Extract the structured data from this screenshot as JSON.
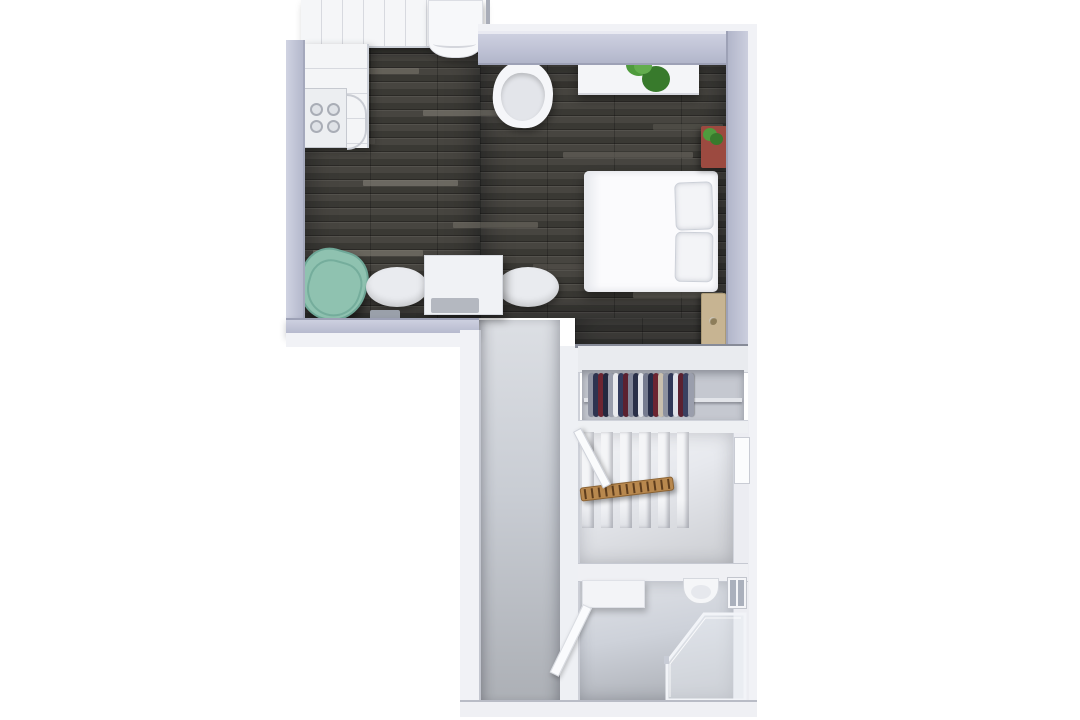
{
  "scene": {
    "kind": "3d-floorplan-top-down-render",
    "background": "#ffffff"
  },
  "palette": {
    "wall": "#c0c3d5",
    "wall_edge": "#9da1b6",
    "wall_outer": "#f1f2f6",
    "wood_base": "#474540",
    "carpet_base": "#cdd1d8",
    "stair_floor": "#e7e9ee",
    "bath_floor": "#ced2da",
    "furniture_white": "#f5f6f9",
    "teal_chair": "#8fc2b0",
    "teal_chair_line": "#6ea797",
    "dresser_red": "#9c4a40",
    "door_tan": "#c7b492",
    "railing_wood": "#b8884e",
    "railing_rung": "#5e3d1d",
    "plant_green": "#4f9b3d",
    "plant_green_dark": "#387a2c",
    "glass": "#ebeef4"
  },
  "kitchen": {
    "burner_count": 4
  },
  "stairs": {
    "tread_count": 6,
    "railing_rung_count": 13
  },
  "closet": {
    "clothes_colors": [
      "#8d91a0",
      "#2e3450",
      "#6d2531",
      "#23283f",
      "#9a9eac",
      "#e9eaee",
      "#323a5c",
      "#5c2130",
      "#82879a",
      "#2a3049",
      "#e4e6ec",
      "#777c90",
      "#262c47",
      "#6d2531",
      "#c9bfae",
      "#8d91a0",
      "#303757",
      "#dfe1e8",
      "#5c2130",
      "#3a4161",
      "#9a9eac"
    ]
  },
  "floor_planks": [
    {
      "x": 30,
      "y": 28,
      "w": 86,
      "c": "#817d74"
    },
    {
      "x": 200,
      "y": 42,
      "w": 120,
      "c": "#2f2e2a"
    },
    {
      "x": 120,
      "y": 70,
      "w": 100,
      "c": "#8a867c"
    },
    {
      "x": 0,
      "y": 98,
      "w": 72,
      "c": "#5d5b54"
    },
    {
      "x": 260,
      "y": 112,
      "w": 130,
      "c": "#767269"
    },
    {
      "x": 60,
      "y": 140,
      "w": 95,
      "c": "#8f8b81"
    },
    {
      "x": 300,
      "y": 154,
      "w": 100,
      "c": "#333129"
    },
    {
      "x": 150,
      "y": 182,
      "w": 85,
      "c": "#7c786e"
    },
    {
      "x": 10,
      "y": 210,
      "w": 110,
      "c": "#898579"
    },
    {
      "x": 230,
      "y": 224,
      "w": 95,
      "c": "#5f5c55"
    },
    {
      "x": 90,
      "y": 252,
      "w": 120,
      "c": "#837f75"
    },
    {
      "x": 330,
      "y": 252,
      "w": 90,
      "c": "#8c887e"
    },
    {
      "x": 180,
      "y": 0,
      "w": 90,
      "c": "#706c64"
    },
    {
      "x": 350,
      "y": 84,
      "w": 70,
      "c": "#605d55"
    }
  ]
}
